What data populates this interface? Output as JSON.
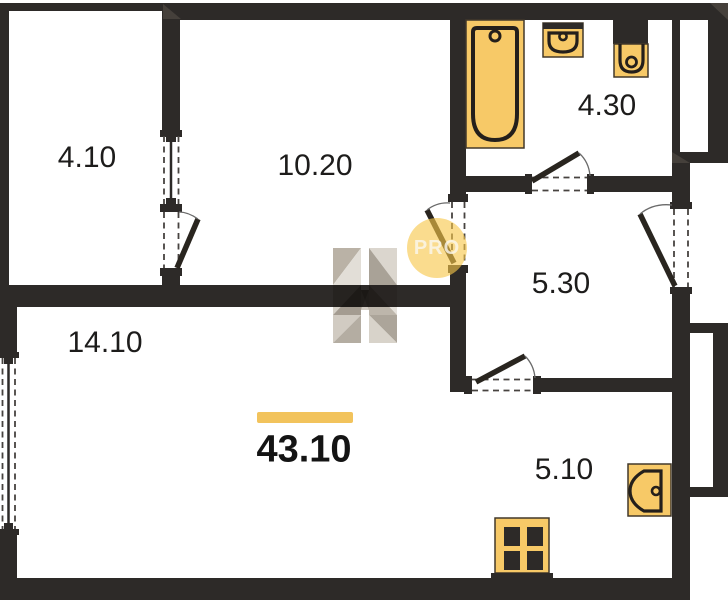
{
  "plan": {
    "title": "apartment-floor-plan",
    "total_area_label": "43.10",
    "watermark": {
      "logo_letter": "H",
      "badge": "PRO"
    },
    "rooms": [
      {
        "id": "balcony",
        "area": "4.10"
      },
      {
        "id": "bedroom",
        "area": "10.20"
      },
      {
        "id": "bathroom",
        "area": "4.30"
      },
      {
        "id": "hallway",
        "area": "5.30"
      },
      {
        "id": "living-room",
        "area": "14.10"
      },
      {
        "id": "kitchen",
        "area": "5.10"
      }
    ],
    "fixtures": [
      "bathtub",
      "wash-basin",
      "toilet",
      "stove",
      "kitchen-sink"
    ],
    "colors": {
      "wall": "#2d2a28",
      "fixture_fill": "#f7c967",
      "fixture_stroke": "#241f1b",
      "accent_bar": "#f2c35c",
      "pro_circle": "rgba(247,198,73,0.62)"
    }
  }
}
